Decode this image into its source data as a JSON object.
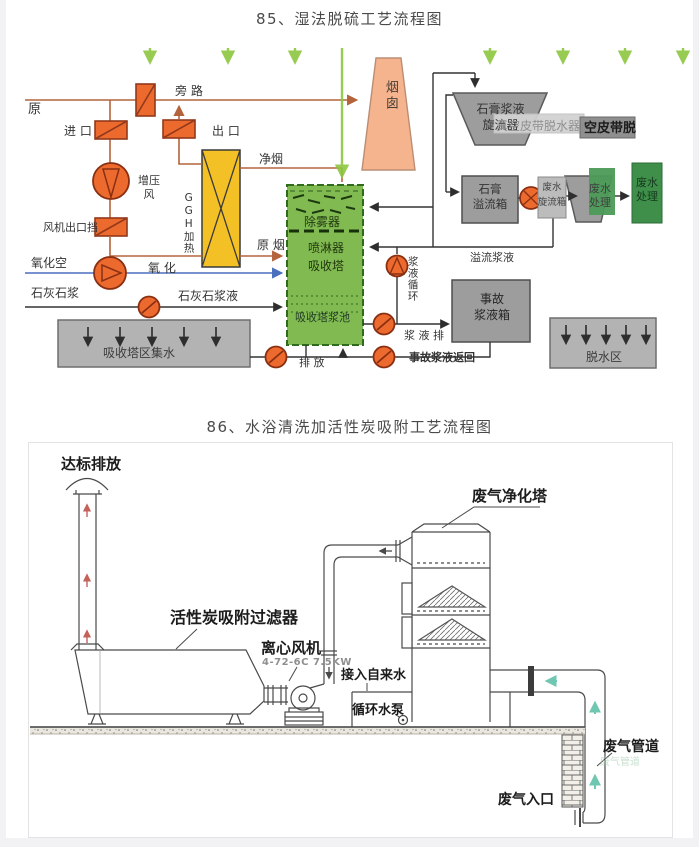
{
  "page": {
    "background": "#f2f2f5",
    "sheet": "#ffffff"
  },
  "d1": {
    "title": "85、湿法脱硫工艺流程图",
    "colors": {
      "damper_orange": "#ed6a2f",
      "ggh_yellow": "#f3c125",
      "tower_green": "#82ba52",
      "chimney_salmon": "#f5b48e",
      "watermark_arrow_green": "#8dc63f",
      "equipment_gray": "#9d9d9d",
      "treatment_green": "#3f8f4a",
      "flue_line_brown": "#b4643c",
      "oxidation_blue": "#4a6fbd"
    },
    "labels": {
      "raw_gas_short": "原",
      "inlet": "进 口",
      "bypass": "旁 路",
      "outlet": "出 口",
      "booster_fan": "增压\n风",
      "fan_outlet_damper": "风机出口挡",
      "ggh_heater": "GGH加热",
      "clean_gas": "净烟",
      "raw_gas": "原 烟",
      "chimney": "烟囱",
      "demister": "除雾器",
      "sprayer": "喷淋器",
      "absorber_tower": "吸收塔",
      "absorber_pool": "吸收塔浆池",
      "oxidation_air": "氧化空",
      "oxidation": "氧 化",
      "limestone": "石灰石浆",
      "limestone_slurry": "石灰石浆液",
      "tower_area_water": "吸收塔区集水",
      "discharge": "排 放",
      "slurry_circulation": "浆液循环",
      "slurry_drain": "浆 液 排",
      "emergency_tank": "事故\n浆液箱",
      "emergency_return": "事故浆液返回",
      "gypsum_cyclone": "石膏浆液\n旋流器",
      "vacuum_belt": "真空皮带脱水器",
      "belt_overlay": "空皮带脱",
      "gypsum_overflow": "石膏\n溢流箱",
      "wastewater_cyclone": "废水\n旋流箱",
      "wastewater_treatment_a": "废水\n处理",
      "wastewater_treatment_b": "废水\n处理",
      "overflow_slurry": "溢流浆液",
      "dewatering_zone": "脱水区"
    }
  },
  "d2": {
    "title": "86、水浴清洗加活性炭吸附工艺流程图",
    "colors": {
      "line": "#4a4a4a",
      "flow_arrow_teal": "#6fc7b2",
      "flow_arrow_red": "#c4625a"
    },
    "labels": {
      "compliant_discharge": "达标排放",
      "carbon_filter": "活性炭吸附过滤器",
      "centrifugal_fan": "离心风机",
      "fan_model": "4-72-6C 7.5KW",
      "purification_tower": "废气净化塔",
      "tap_water": "接入自来水",
      "circulating_pump": "循环水泵",
      "gas_pipe": "废气管道",
      "gas_inlet": "废气入口",
      "watermark": "废气管道"
    }
  }
}
